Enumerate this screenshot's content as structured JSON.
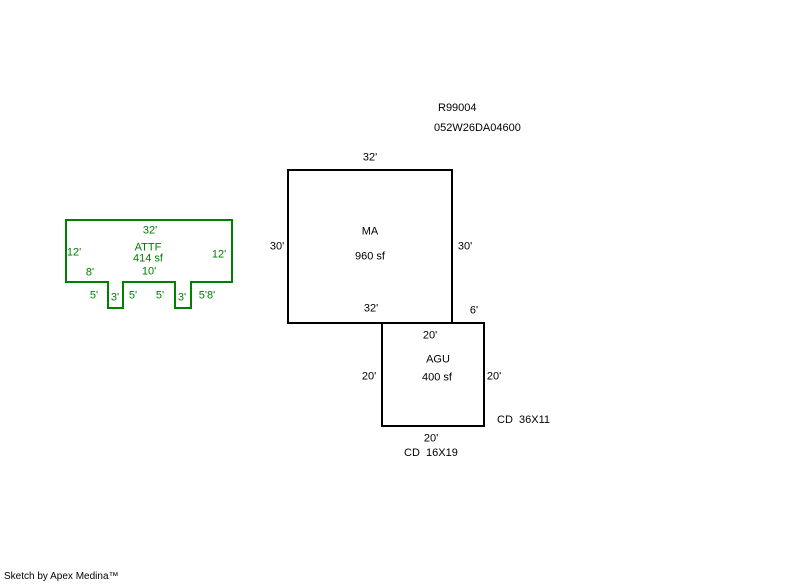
{
  "header": {
    "record_number": "R99004",
    "parcel_number": "052W26DA04600"
  },
  "colors": {
    "attf": "#008000",
    "main": "#000000"
  },
  "attf": {
    "name": "ATTF",
    "area": "414 sf",
    "dim_top": "32'",
    "dim_left": "12'",
    "dim_right": "12'",
    "dim_bottom_left": "8'",
    "dim_bottom_mid": "10'",
    "dim_notch": [
      "5'",
      "3'",
      "5'",
      "5'",
      "3'",
      "5'8'"
    ]
  },
  "ma": {
    "name": "MA",
    "area": "960 sf",
    "dim_top": "32'",
    "dim_left": "30'",
    "dim_right": "30'",
    "dim_bottom": "32'",
    "dim_extension": "6'"
  },
  "agu": {
    "name": "AGU",
    "area": "400 sf",
    "dim_top": "20'",
    "dim_left": "20'",
    "dim_right": "20'",
    "dim_bottom": "20'",
    "note_right": "CD  36X11",
    "note_bottom": "CD  16X19"
  },
  "footer": {
    "credit": "Sketch by Apex Medina™"
  }
}
